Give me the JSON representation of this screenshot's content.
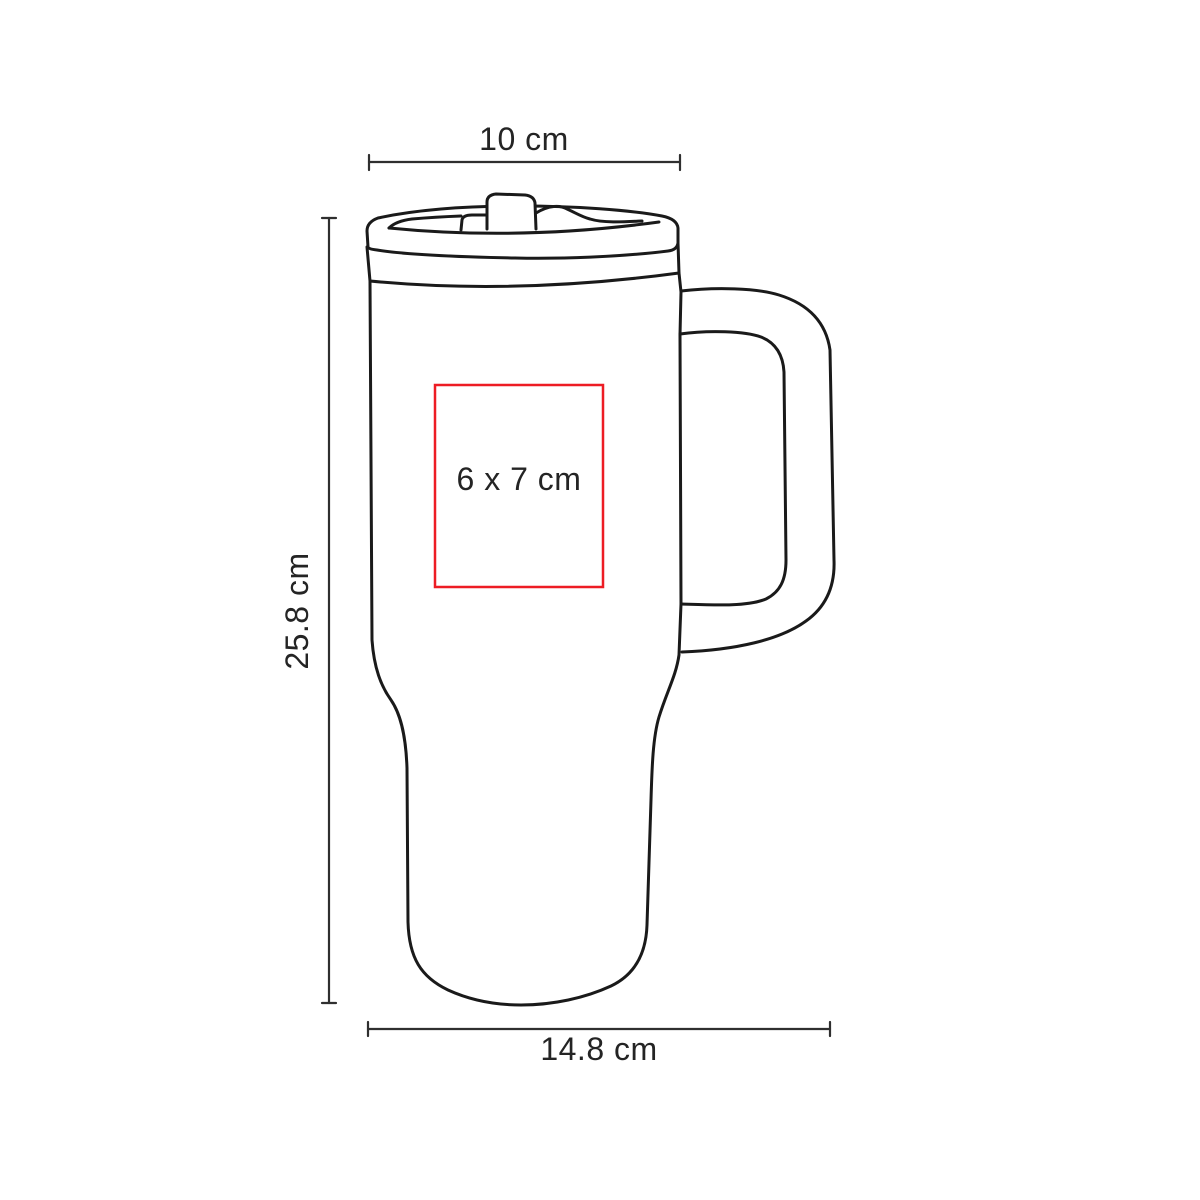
{
  "page": {
    "background": "#ffffff"
  },
  "diagram": {
    "subject": "insulated-travel-mug-with-handle-and-straw-lid",
    "outline_color": "#1a1a1a",
    "dimension_line_color": "#2f2f2f",
    "text_color": "#242424",
    "imprint_box_color": "#ed1c24",
    "labels": {
      "top_width": "10 cm",
      "height": "25.8 cm",
      "base_width": "14.8 cm",
      "imprint_area": "6 x 7 cm"
    }
  }
}
